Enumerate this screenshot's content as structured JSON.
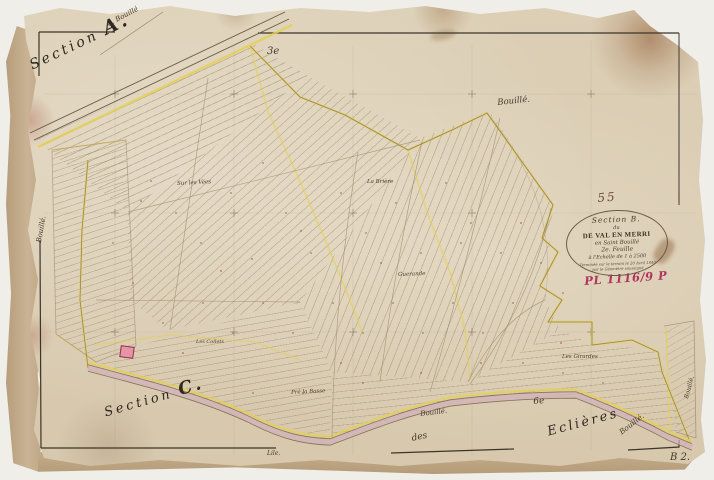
{
  "colors": {
    "paper": "#dccfb6",
    "boundary_yellow": "#e4d052",
    "road_mauve": "#cfb1bb",
    "ink": "#453a2b",
    "archive_red": "#b0345c",
    "building_pink": "#e596a4"
  },
  "labels": {
    "section_word": "Section",
    "section_a_letter": "A.",
    "section_c_letter": "C.",
    "chemin_bouille": "C. Bouillé",
    "sheet_3": "3e",
    "sheet_6": "6e",
    "bouille": "Bouillé.",
    "sur_les_vees": "Sur les Vées",
    "la_briere": "La Brière",
    "guerande": "Guerande",
    "les_collets": "Les Collets",
    "pre_la_basse": "Pré la Basse",
    "les_girardes": "Les Girardes",
    "des": "des",
    "eclieres": "Eclières",
    "lile": "Lile.",
    "sheet_number": "55",
    "archive_ref": "PL 1116/9 P",
    "plate_ref": "B 2."
  },
  "cartouche": {
    "line1": "Section B.",
    "line2": "du",
    "line3": "DE VAL EN MERRI",
    "line4": "en Saint Bouillé",
    "line5": "2e. Feuille",
    "line6": "à l'Echelle de 1 à 2500",
    "line7": "Terminée sur le terrain le 20 Avril 1840",
    "line8": "par le Géomètre soussigné"
  }
}
